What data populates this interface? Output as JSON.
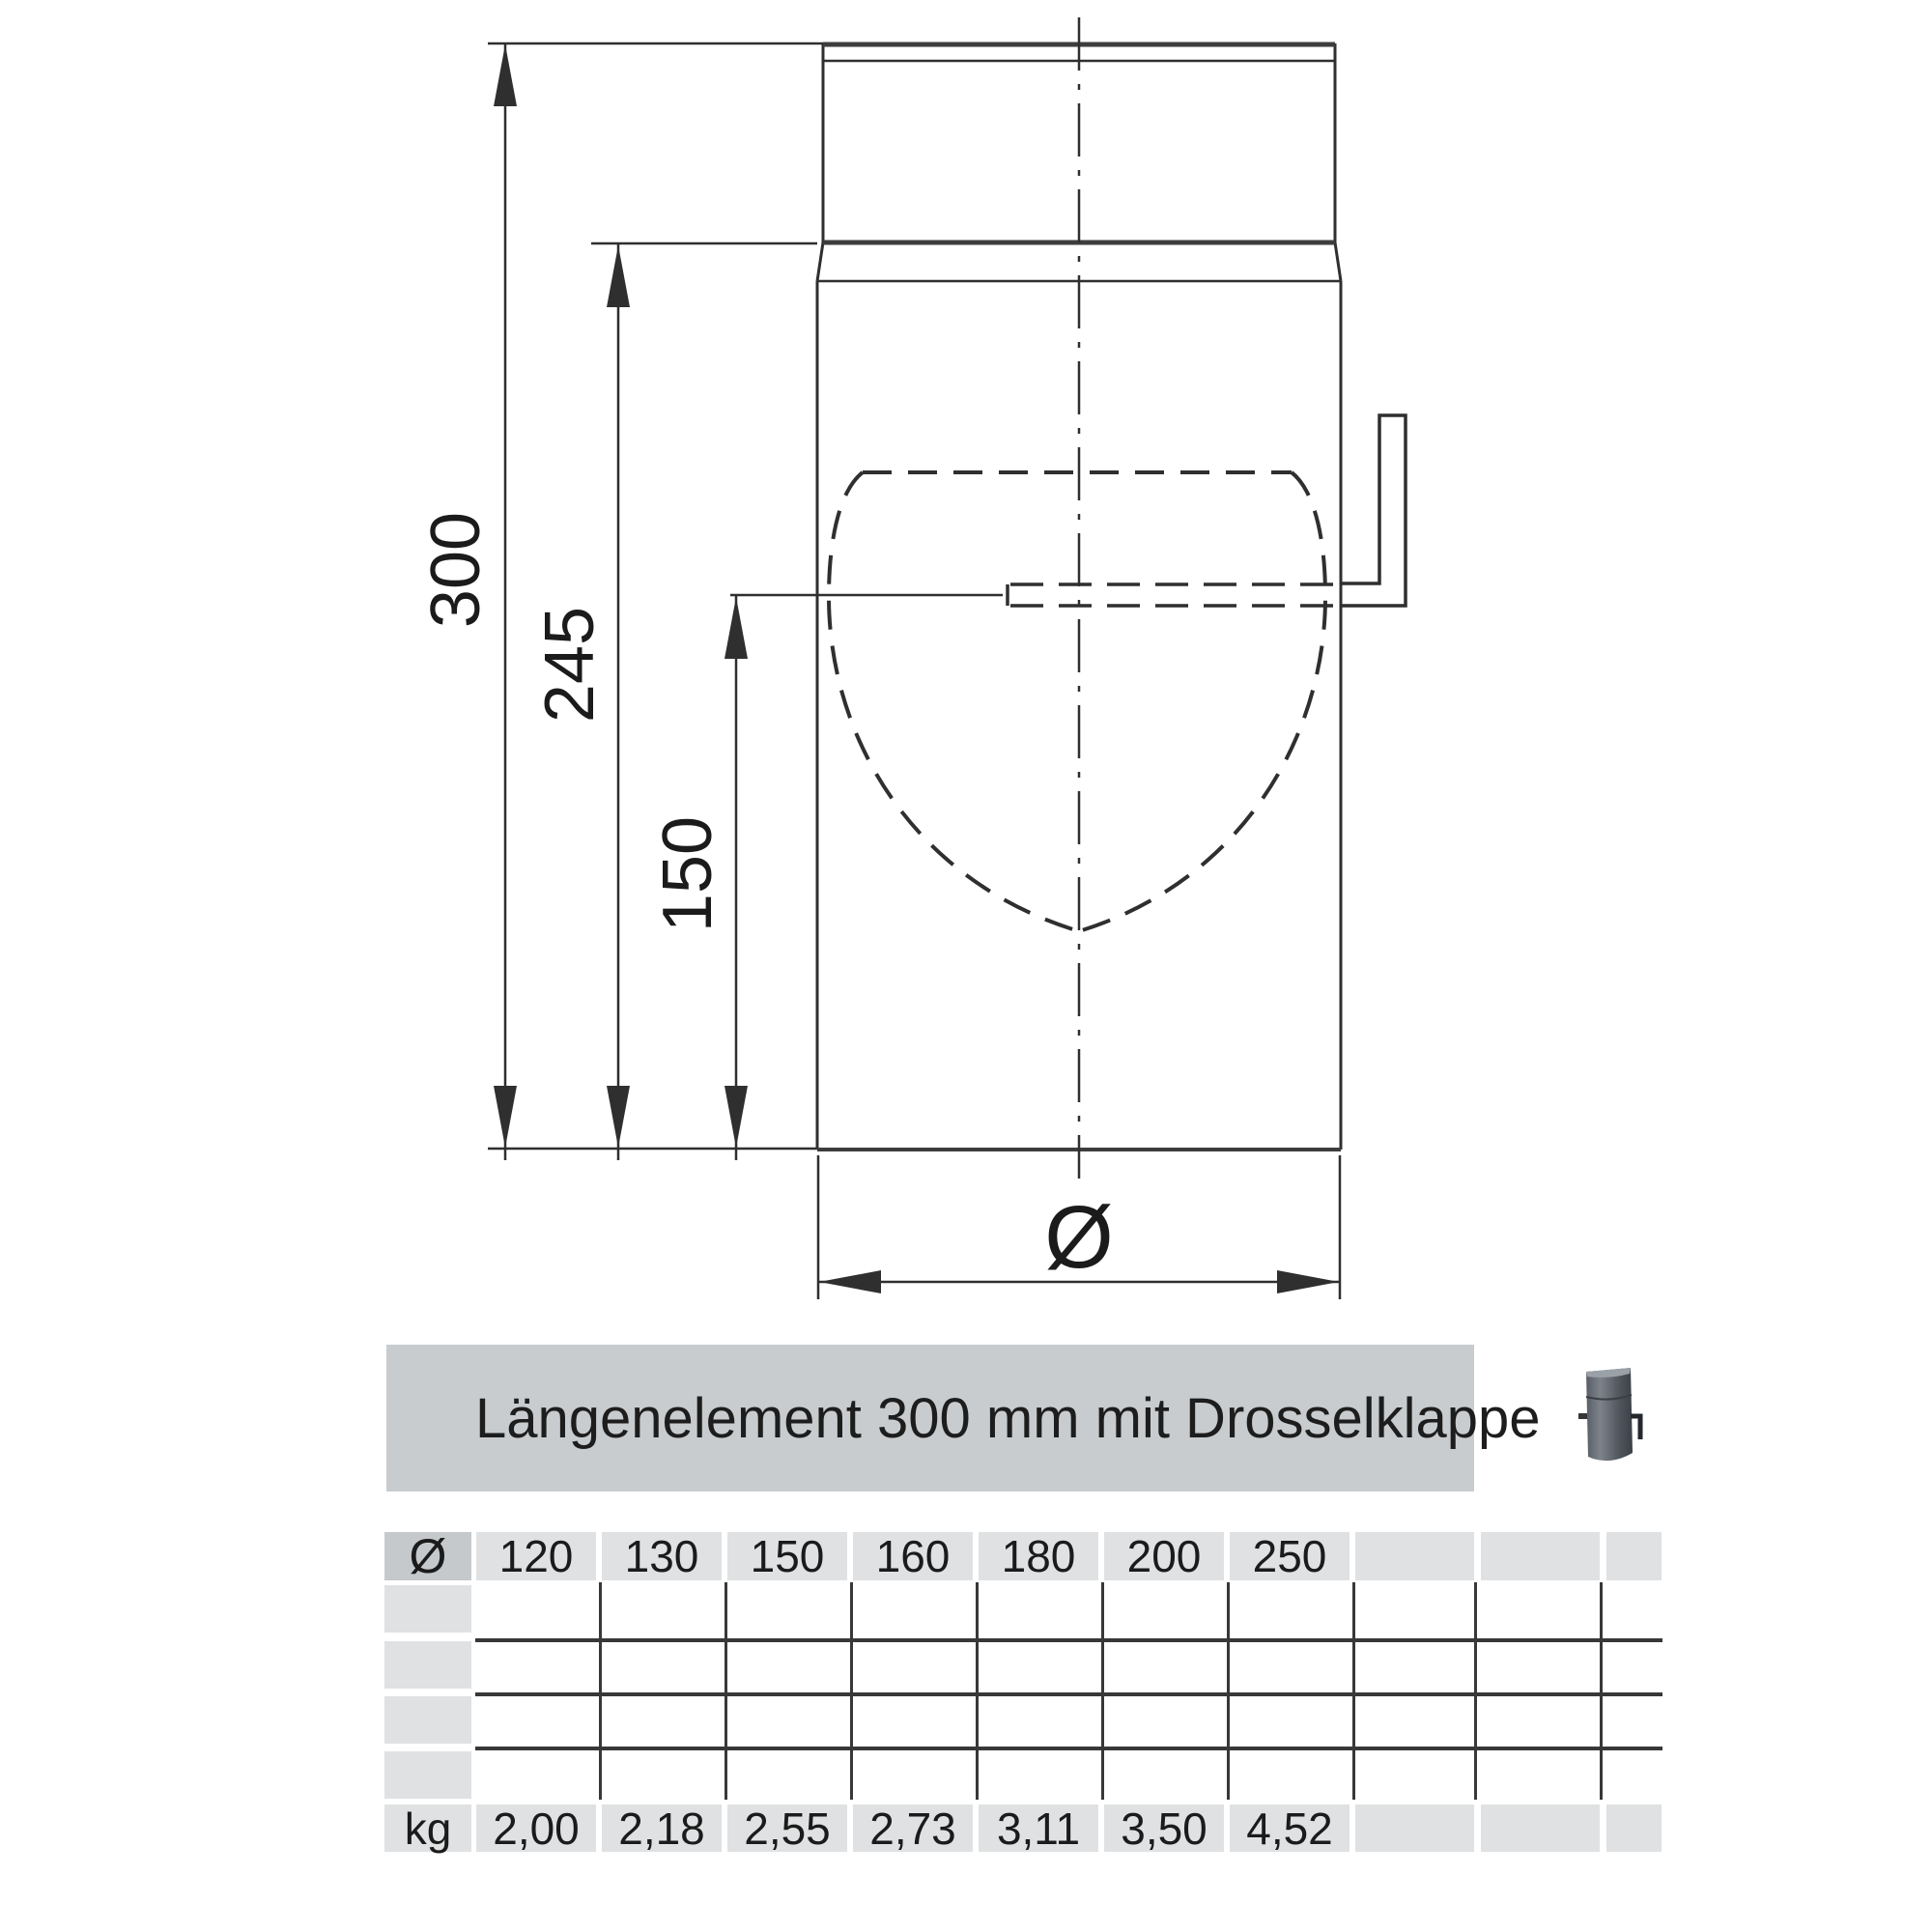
{
  "drawing": {
    "dimensions": {
      "total_length": "300",
      "length_below_socket": "245",
      "axis_height": "150"
    },
    "diameter_symbol": "Ø"
  },
  "banner": {
    "title": "Längenelement 300 mm mit Drosselklappe"
  },
  "table": {
    "diameter_header": {
      "label": "Ø",
      "values": [
        "120",
        "130",
        "150",
        "160",
        "180",
        "200",
        "250"
      ],
      "empty_cols": 3
    },
    "spacer_rows": 4,
    "weight_row": {
      "label": "kg",
      "values": [
        "2,00",
        "2,18",
        "2,55",
        "2,73",
        "3,11",
        "3,50",
        "4,52"
      ]
    }
  },
  "colors": {
    "banner_bg": "#c8ccce",
    "cell_bg": "#dfe1e2",
    "cell_bg_dark": "#c5c9cc",
    "drawing_line": "#2f2f2f",
    "grid_line": "#383838"
  }
}
